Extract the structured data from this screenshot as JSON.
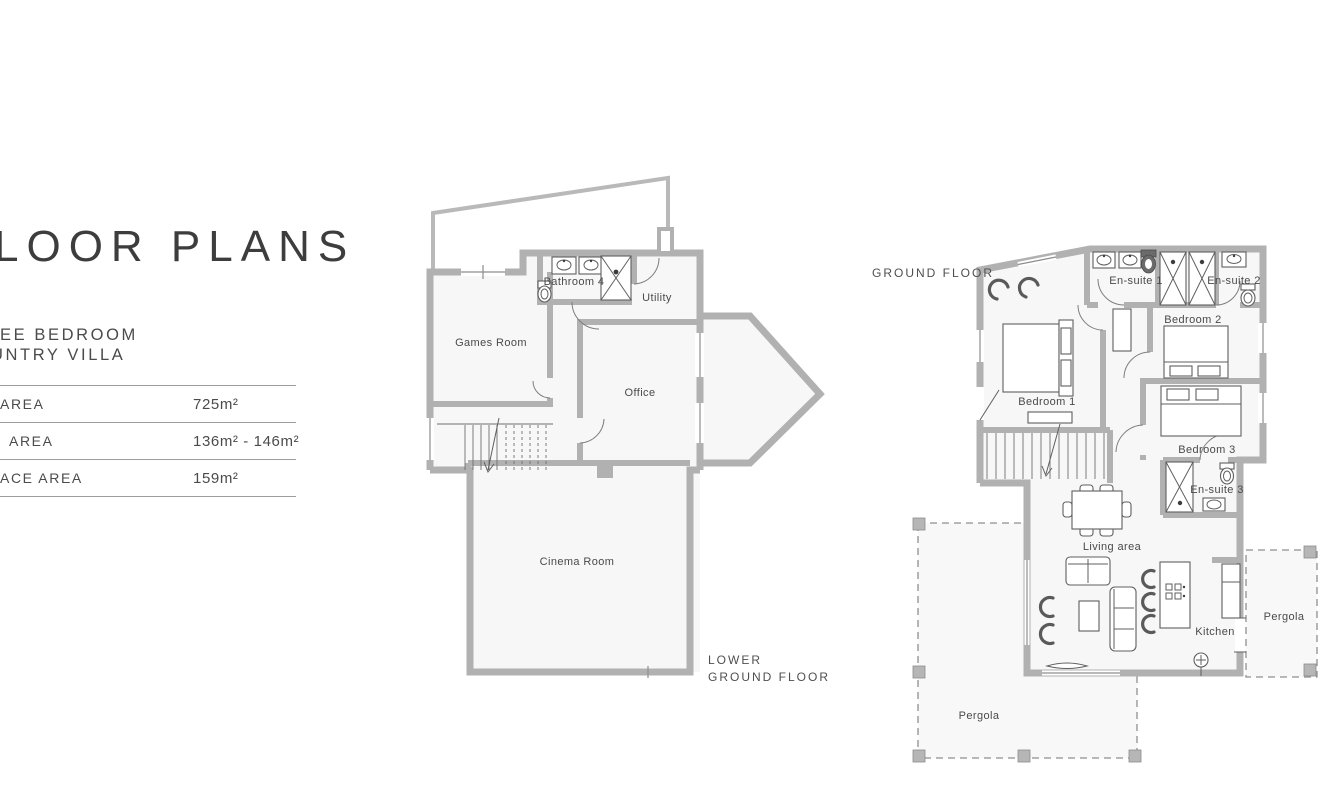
{
  "left_panel": {
    "title": "LOOR PLANS",
    "subtitle_line1": "EE BEDROOM",
    "subtitle_line2": "UNTRY VILLA",
    "table": {
      "rows": [
        {
          "label": "AREA",
          "value": "725m²"
        },
        {
          "label": "AREA",
          "value": "136m² - 146m²"
        },
        {
          "label": "ACE AREA",
          "value": "159m²"
        }
      ]
    }
  },
  "lower_floor": {
    "caption_line1": "LOWER",
    "caption_line2": "GROUND FLOOR",
    "rooms": {
      "games_room": "Games Room",
      "bathroom4": "Bathroom 4",
      "utility": "Utility",
      "office": "Office",
      "cinema_room": "Cinema Room"
    }
  },
  "ground_floor": {
    "caption": "GROUND FLOOR",
    "rooms": {
      "ensuite1": "En-suite 1",
      "ensuite2": "En-suite 2",
      "ensuite3": "En-suite 3",
      "bedroom1": "Bedroom 1",
      "bedroom2": "Bedroom 2",
      "bedroom3": "Bedroom 3",
      "living": "Living area",
      "kitchen": "Kitchen",
      "pergola_right": "Pergola",
      "pergola_bottom": "Pergola"
    }
  },
  "colors": {
    "wall": "#b1b1b1",
    "floor": "#f7f7f7",
    "text": "#4a4a4a"
  }
}
